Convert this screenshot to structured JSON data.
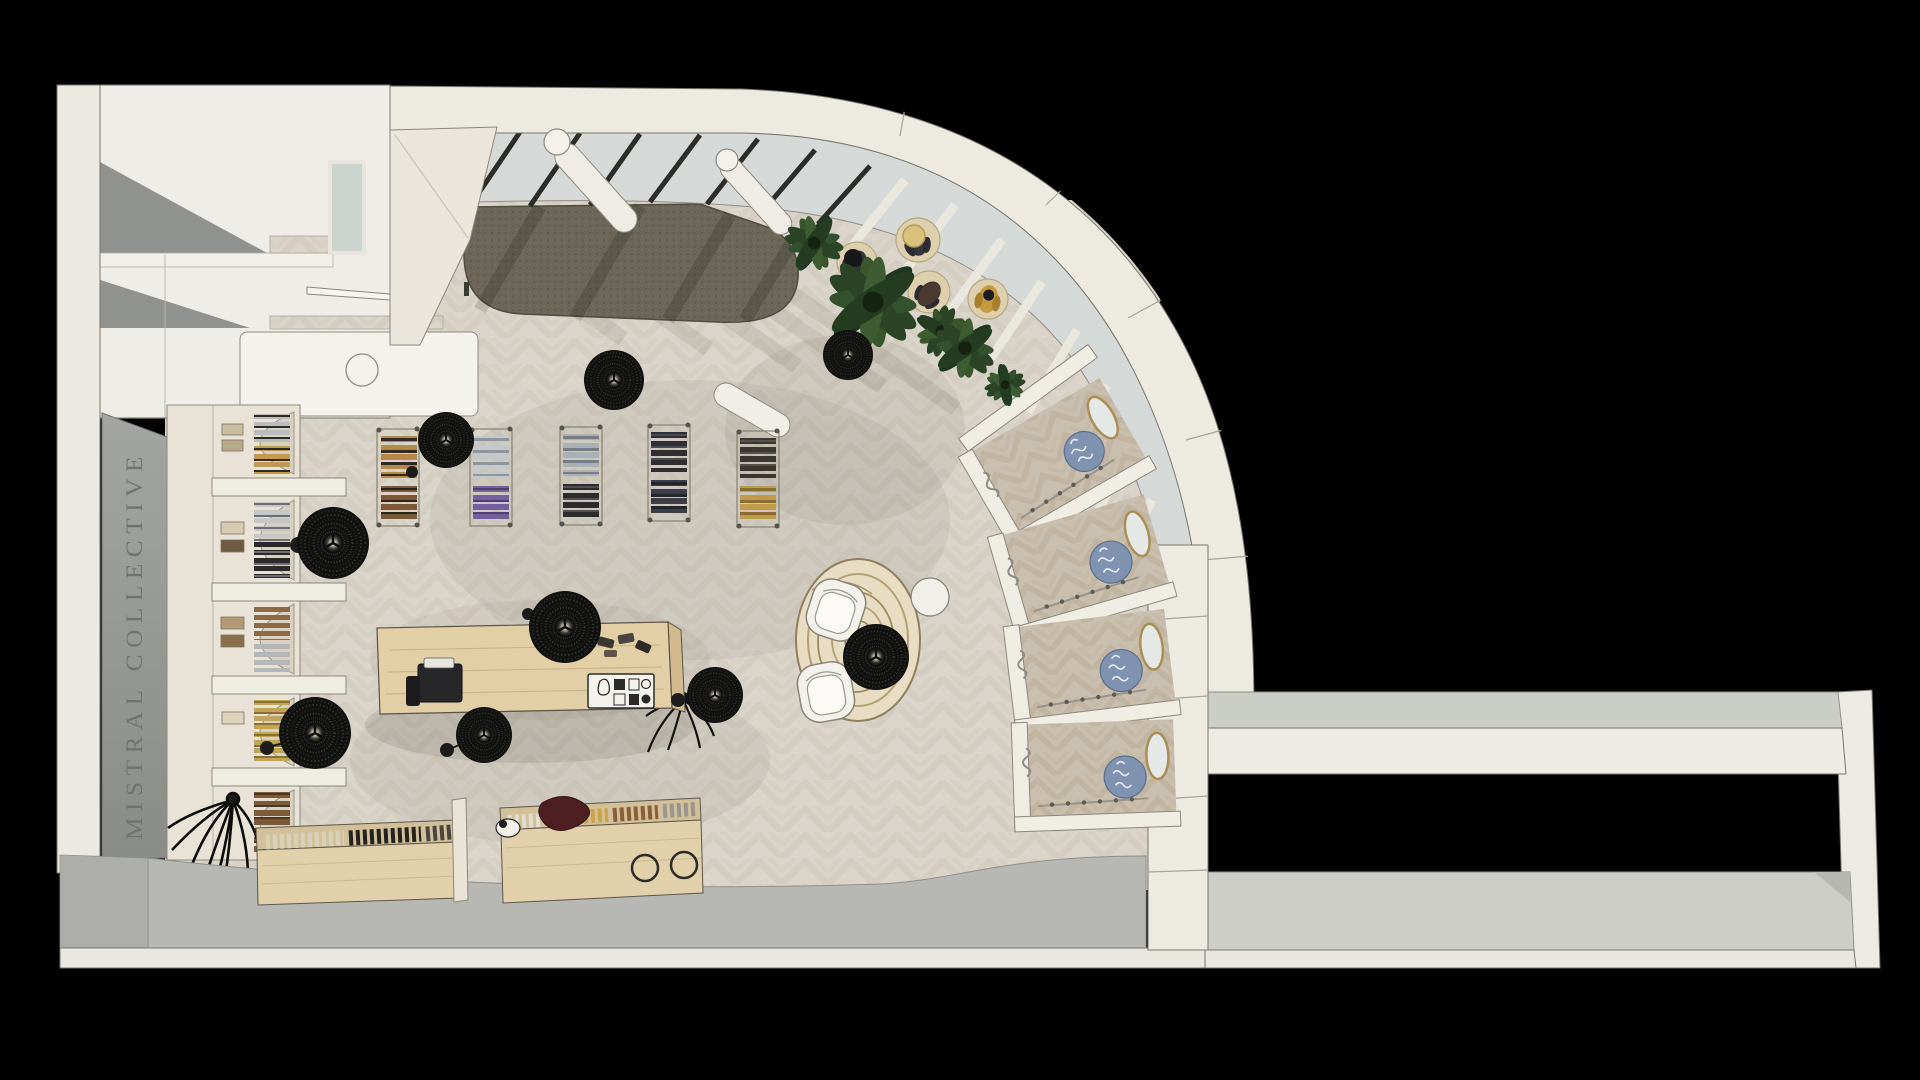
{
  "page": {
    "title": "Top-down 3D rendering of a retail store floor plan",
    "background": "#000000"
  },
  "branding": {
    "store_name_wall_text": "MISTRAL COLLECTIVE"
  },
  "palette": {
    "background": "#000000",
    "wall_cream": "#edeae2",
    "wall_bright": "#f3f1ea",
    "signage_wall_gray": "#9a9c99",
    "signage_text_gray": "#6f7370",
    "floor_wood_light": "#dad4ca",
    "floor_wood_bay": "#c9bfae",
    "carpet_olive": "#6b6658",
    "concrete_gray": "#b7b8b4",
    "roof_gray": "#cccec7",
    "glass": "#d5dad9",
    "mullion_dark": "#2c2c29",
    "counter_wood": "#e3cfa6",
    "lamp_black": "#141414",
    "plant_green": "#33512c",
    "sphere_blue": "#7f92b0",
    "mirror_trim_gold": "#a98f55"
  },
  "scene": {
    "areas": [
      {
        "label": "back-of-house rooms"
      },
      {
        "label": "window display zone with olive carpet"
      },
      {
        "label": "glazed skylight and curved facade"
      },
      {
        "label": "entry lounge with mannequin platforms and plants"
      },
      {
        "label": "sales floor with garment racks"
      },
      {
        "label": "cash desk"
      },
      {
        "label": "lounge with round rug and armchairs"
      },
      {
        "label": "curved accessory bays with mirrors and blue spheres"
      },
      {
        "label": "shoe display tables"
      },
      {
        "label": "store name signage wall"
      },
      {
        "label": "entry walkway"
      },
      {
        "label": "adjacent volume bottom right"
      }
    ],
    "fixtures": {
      "pendant_lamps_black_wicker": 9,
      "garment_racks": 5,
      "wall_arch_niches": 5,
      "shoe_display_tables": 2,
      "armchairs": 2,
      "round_rug": 1,
      "mannequin_platforms": 4,
      "green_plants": 5,
      "dry_black_plants": 2,
      "accessory_bays": 4,
      "round_columns": 2,
      "cash_desk": 1
    }
  }
}
